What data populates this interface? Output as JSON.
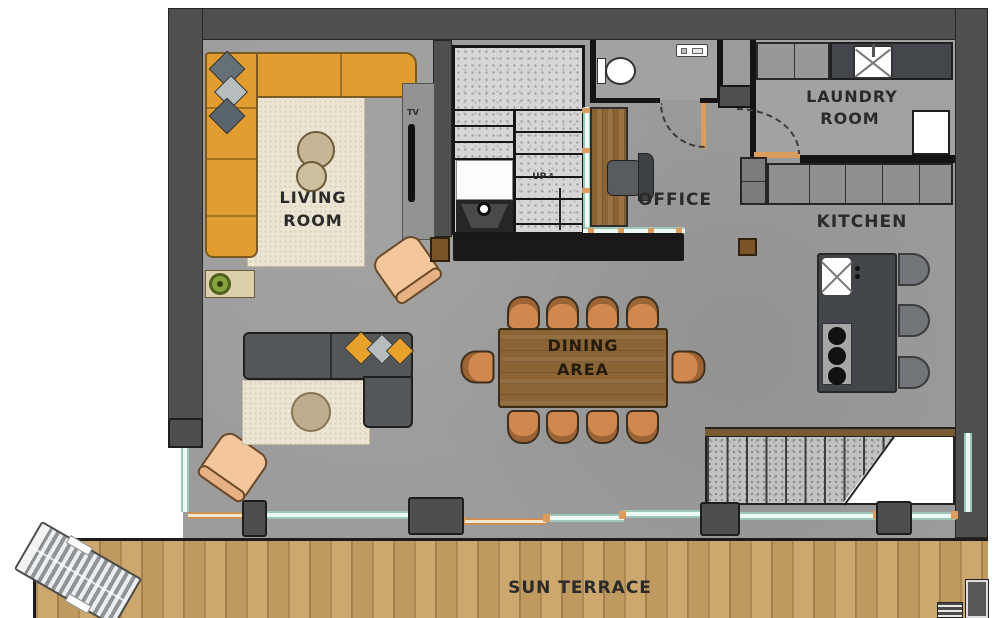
{
  "floor_plan": {
    "rooms": {
      "living_room": {
        "line1": "LIVING",
        "line2": "ROOM"
      },
      "office": {
        "label": "OFFICE"
      },
      "laundry_room": {
        "line1": "LAUNDRY",
        "line2": "ROOM"
      },
      "kitchen": {
        "label": "KITCHEN"
      },
      "dining_area": {
        "line1": "DINING",
        "line2": "AREA"
      },
      "sun_terrace": {
        "label": "SUN TERRACE"
      }
    },
    "annotations": {
      "tv": "TV",
      "stairs_up": "UP",
      "stairs_up_arrow": "↗"
    },
    "colors": {
      "wall": "#4f4f4f",
      "floor_concrete": "#9c9c9c",
      "room_floor": "#a2a2a2",
      "sofa_orange": "#e29d31",
      "sofa_charcoal": "#54575a",
      "rug_cream": "#ece5d3",
      "pillow_orange": "#e8a22c",
      "pillow_gray": "#b7bcbe",
      "dining_table_wood": "#8a6434",
      "dining_chair_wood": "#d0884e",
      "armchair_peach": "#f3c79b",
      "kitchen_island": "#42464a",
      "deck_wood": "#c9a265",
      "glass": "#d7efe6",
      "frame_orange": "#dc9c5e",
      "bench_black": "#191919"
    }
  }
}
